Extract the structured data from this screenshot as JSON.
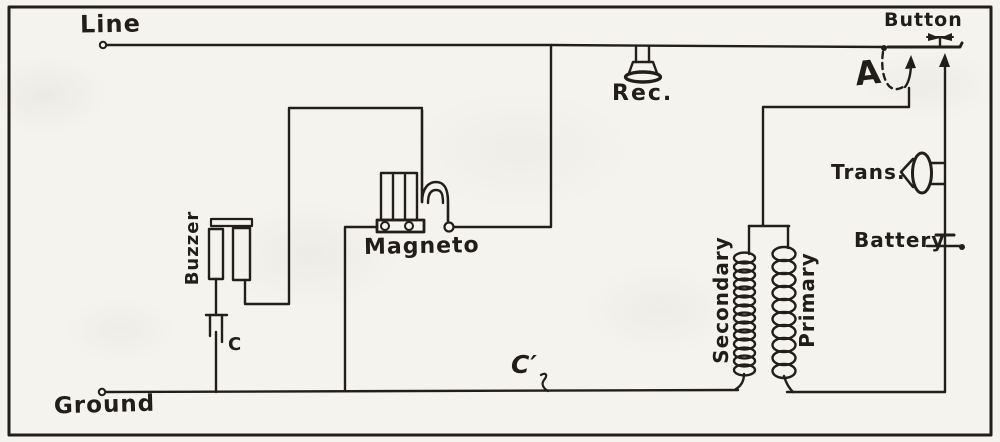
{
  "diagram": {
    "type": "hand-drawn telephone circuit schematic",
    "ink_color": "#221f1b",
    "paper_color": "#f5f3ee",
    "labels": {
      "line": "Line",
      "ground": "Ground",
      "receiver": "Rec.",
      "button": "Button",
      "hook_switch": "A",
      "transmitter": "Trans.",
      "battery": "Battery",
      "magneto": "Magneto",
      "buzzer": "Buzzer",
      "secondary": "Secondary",
      "primary": "Primary",
      "condenser": "C",
      "condenser_prime": "C′"
    }
  }
}
